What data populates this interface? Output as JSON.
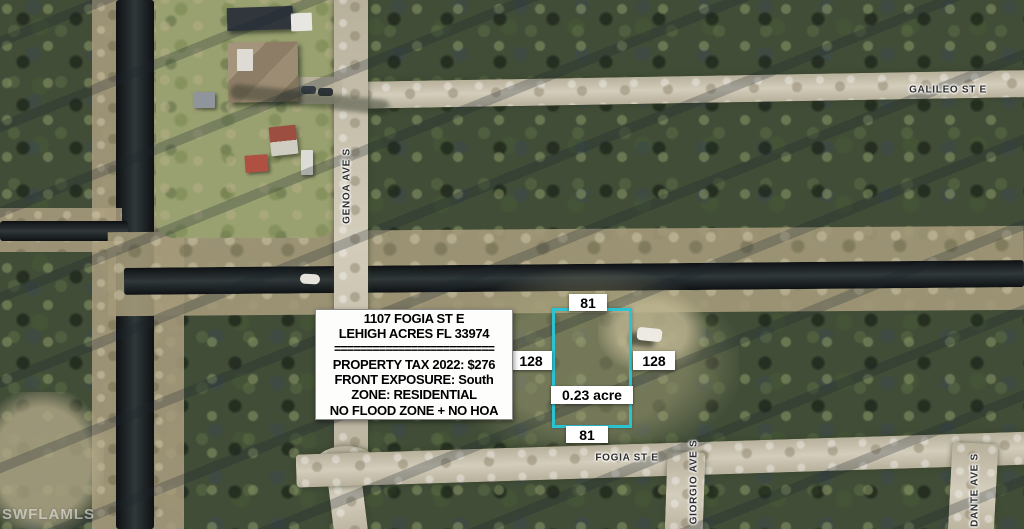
{
  "info_box": {
    "address_line1": "1107 FOGIA ST E",
    "address_line2": "LEHIGH ACRES FL 33974",
    "divider": "=========================",
    "tax": "PROPERTY TAX 2022: $276",
    "exposure": "FRONT EXPOSURE: South",
    "zone": "ZONE: RESIDENTIAL",
    "flood": "NO FLOOD ZONE + NO HOA"
  },
  "lot": {
    "width_top": "81",
    "depth_left": "128",
    "depth_right": "128",
    "width_bottom": "81",
    "area": "0.23 acre",
    "outline_color": "#2bc2d1"
  },
  "streets": {
    "galileo": "GALILEO ST E",
    "genoa": "GENOA AVE S",
    "fogia": "FOGIA ST E",
    "giorgio": "GIORGIO AVE S",
    "dante": "DANTE AVE S"
  },
  "watermark": "SWFLAMLS"
}
